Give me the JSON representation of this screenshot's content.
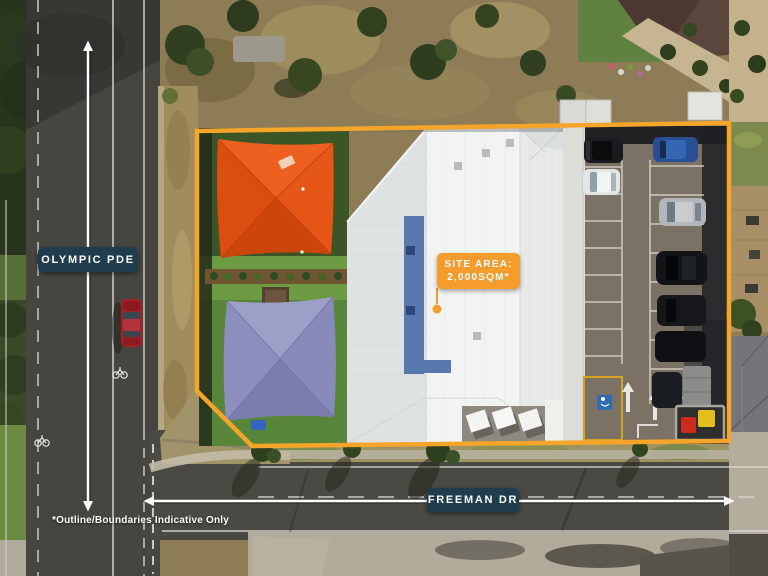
{
  "labels": {
    "street_left": "OLYMPIC PDE",
    "street_bottom": "FREEMAN DR",
    "site_area_line1": "SITE AREA:",
    "site_area_line2": "2,000SQM*",
    "footnote": "*Outline/Boundaries Indicative Only"
  },
  "colors": {
    "street_label_bg": "#1F3D4D",
    "street_label_text": "#FFFFFF",
    "site_area_bg": "#F59C2D",
    "boundary_orange": "#F6A52B",
    "arrow_white": "#FFFFFF"
  },
  "icons": {
    "vertical_arrow": "double-headed-vertical-extent-arrow",
    "horizontal_arrow": "double-headed-horizontal-extent-arrow",
    "pointer_dot": "orange-dot-site-marker"
  }
}
